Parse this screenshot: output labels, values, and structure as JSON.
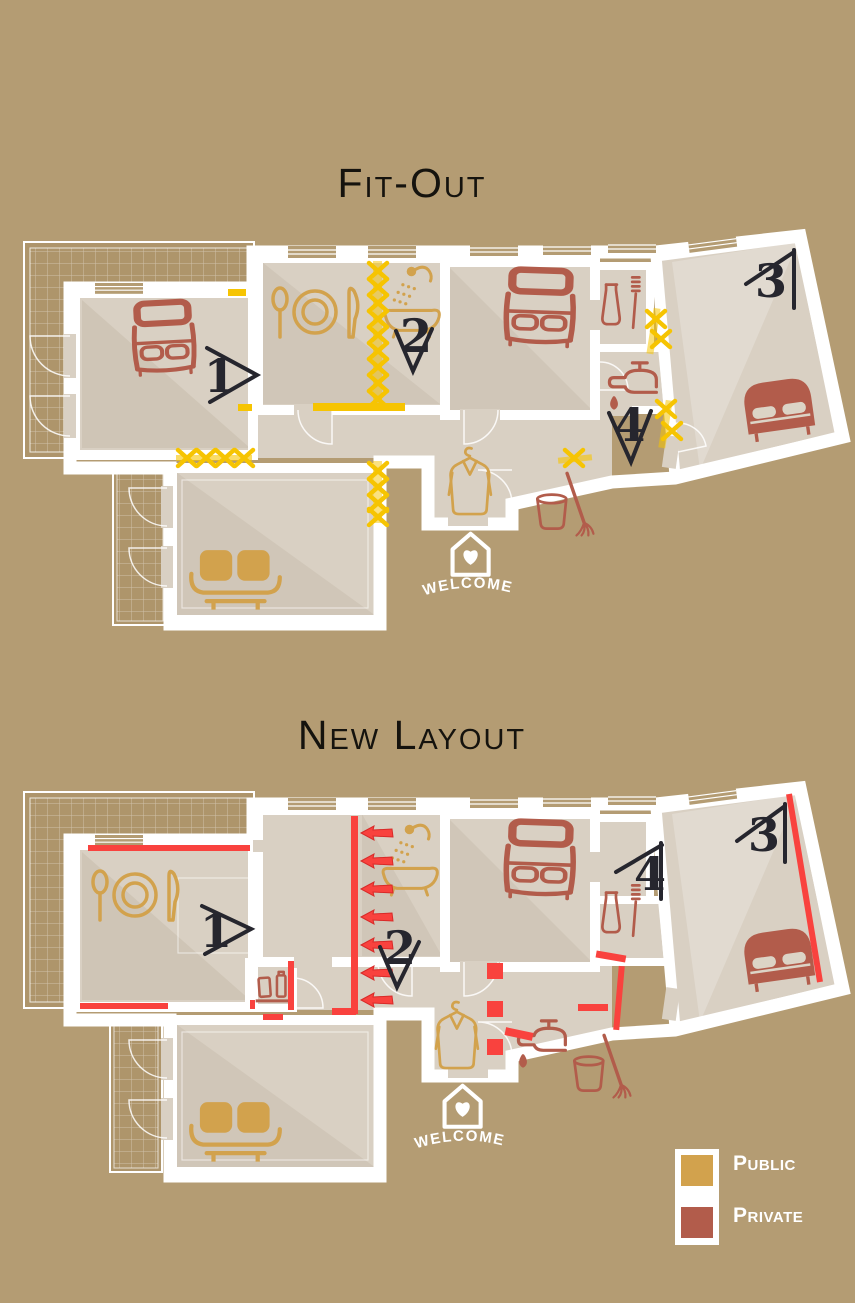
{
  "palette": {
    "bg": "#b49c73",
    "terrace": "#ae956b",
    "floor": "#d9d0c3",
    "floor_shade": "#8b7a5c",
    "wall": "#ffffff",
    "public": "#d2a24d",
    "private": "#b25c4b",
    "demolition": "#f6c402",
    "new_wall": "#f9423e",
    "ink": "#26262e",
    "pillow": "#dcd4c6"
  },
  "plans": [
    {
      "id": "fit-out",
      "title": "Fit-Out",
      "welcome_label": "WELCOME",
      "markers": [
        {
          "label": "1"
        },
        {
          "label": "2"
        },
        {
          "label": "3"
        },
        {
          "label": "4"
        }
      ],
      "icons": [
        "single-bed",
        "plate-and-cutlery",
        "bathtub-shower",
        "single-bed",
        "toothpaste-toothbrush",
        "faucet-drip",
        "double-bed",
        "sofa",
        "coat-hanger",
        "bucket-broom",
        "welcome-house-heart"
      ]
    },
    {
      "id": "new-layout",
      "title": "New Layout",
      "welcome_label": "WELCOME",
      "markers": [
        {
          "label": "1"
        },
        {
          "label": "2"
        },
        {
          "label": "3"
        },
        {
          "label": "4"
        }
      ],
      "icons": [
        "plate-and-cutlery",
        "bathtub-shower",
        "toiletry-bottles",
        "single-bed",
        "toothpaste-toothbrush",
        "double-bed",
        "coat-hanger",
        "faucet-drip",
        "bucket-broom",
        "sofa",
        "welcome-house-heart"
      ]
    }
  ],
  "legend": {
    "items": [
      {
        "label": "Public",
        "color": "#d2a24d"
      },
      {
        "label": "Private",
        "color": "#b25c4b"
      }
    ]
  }
}
